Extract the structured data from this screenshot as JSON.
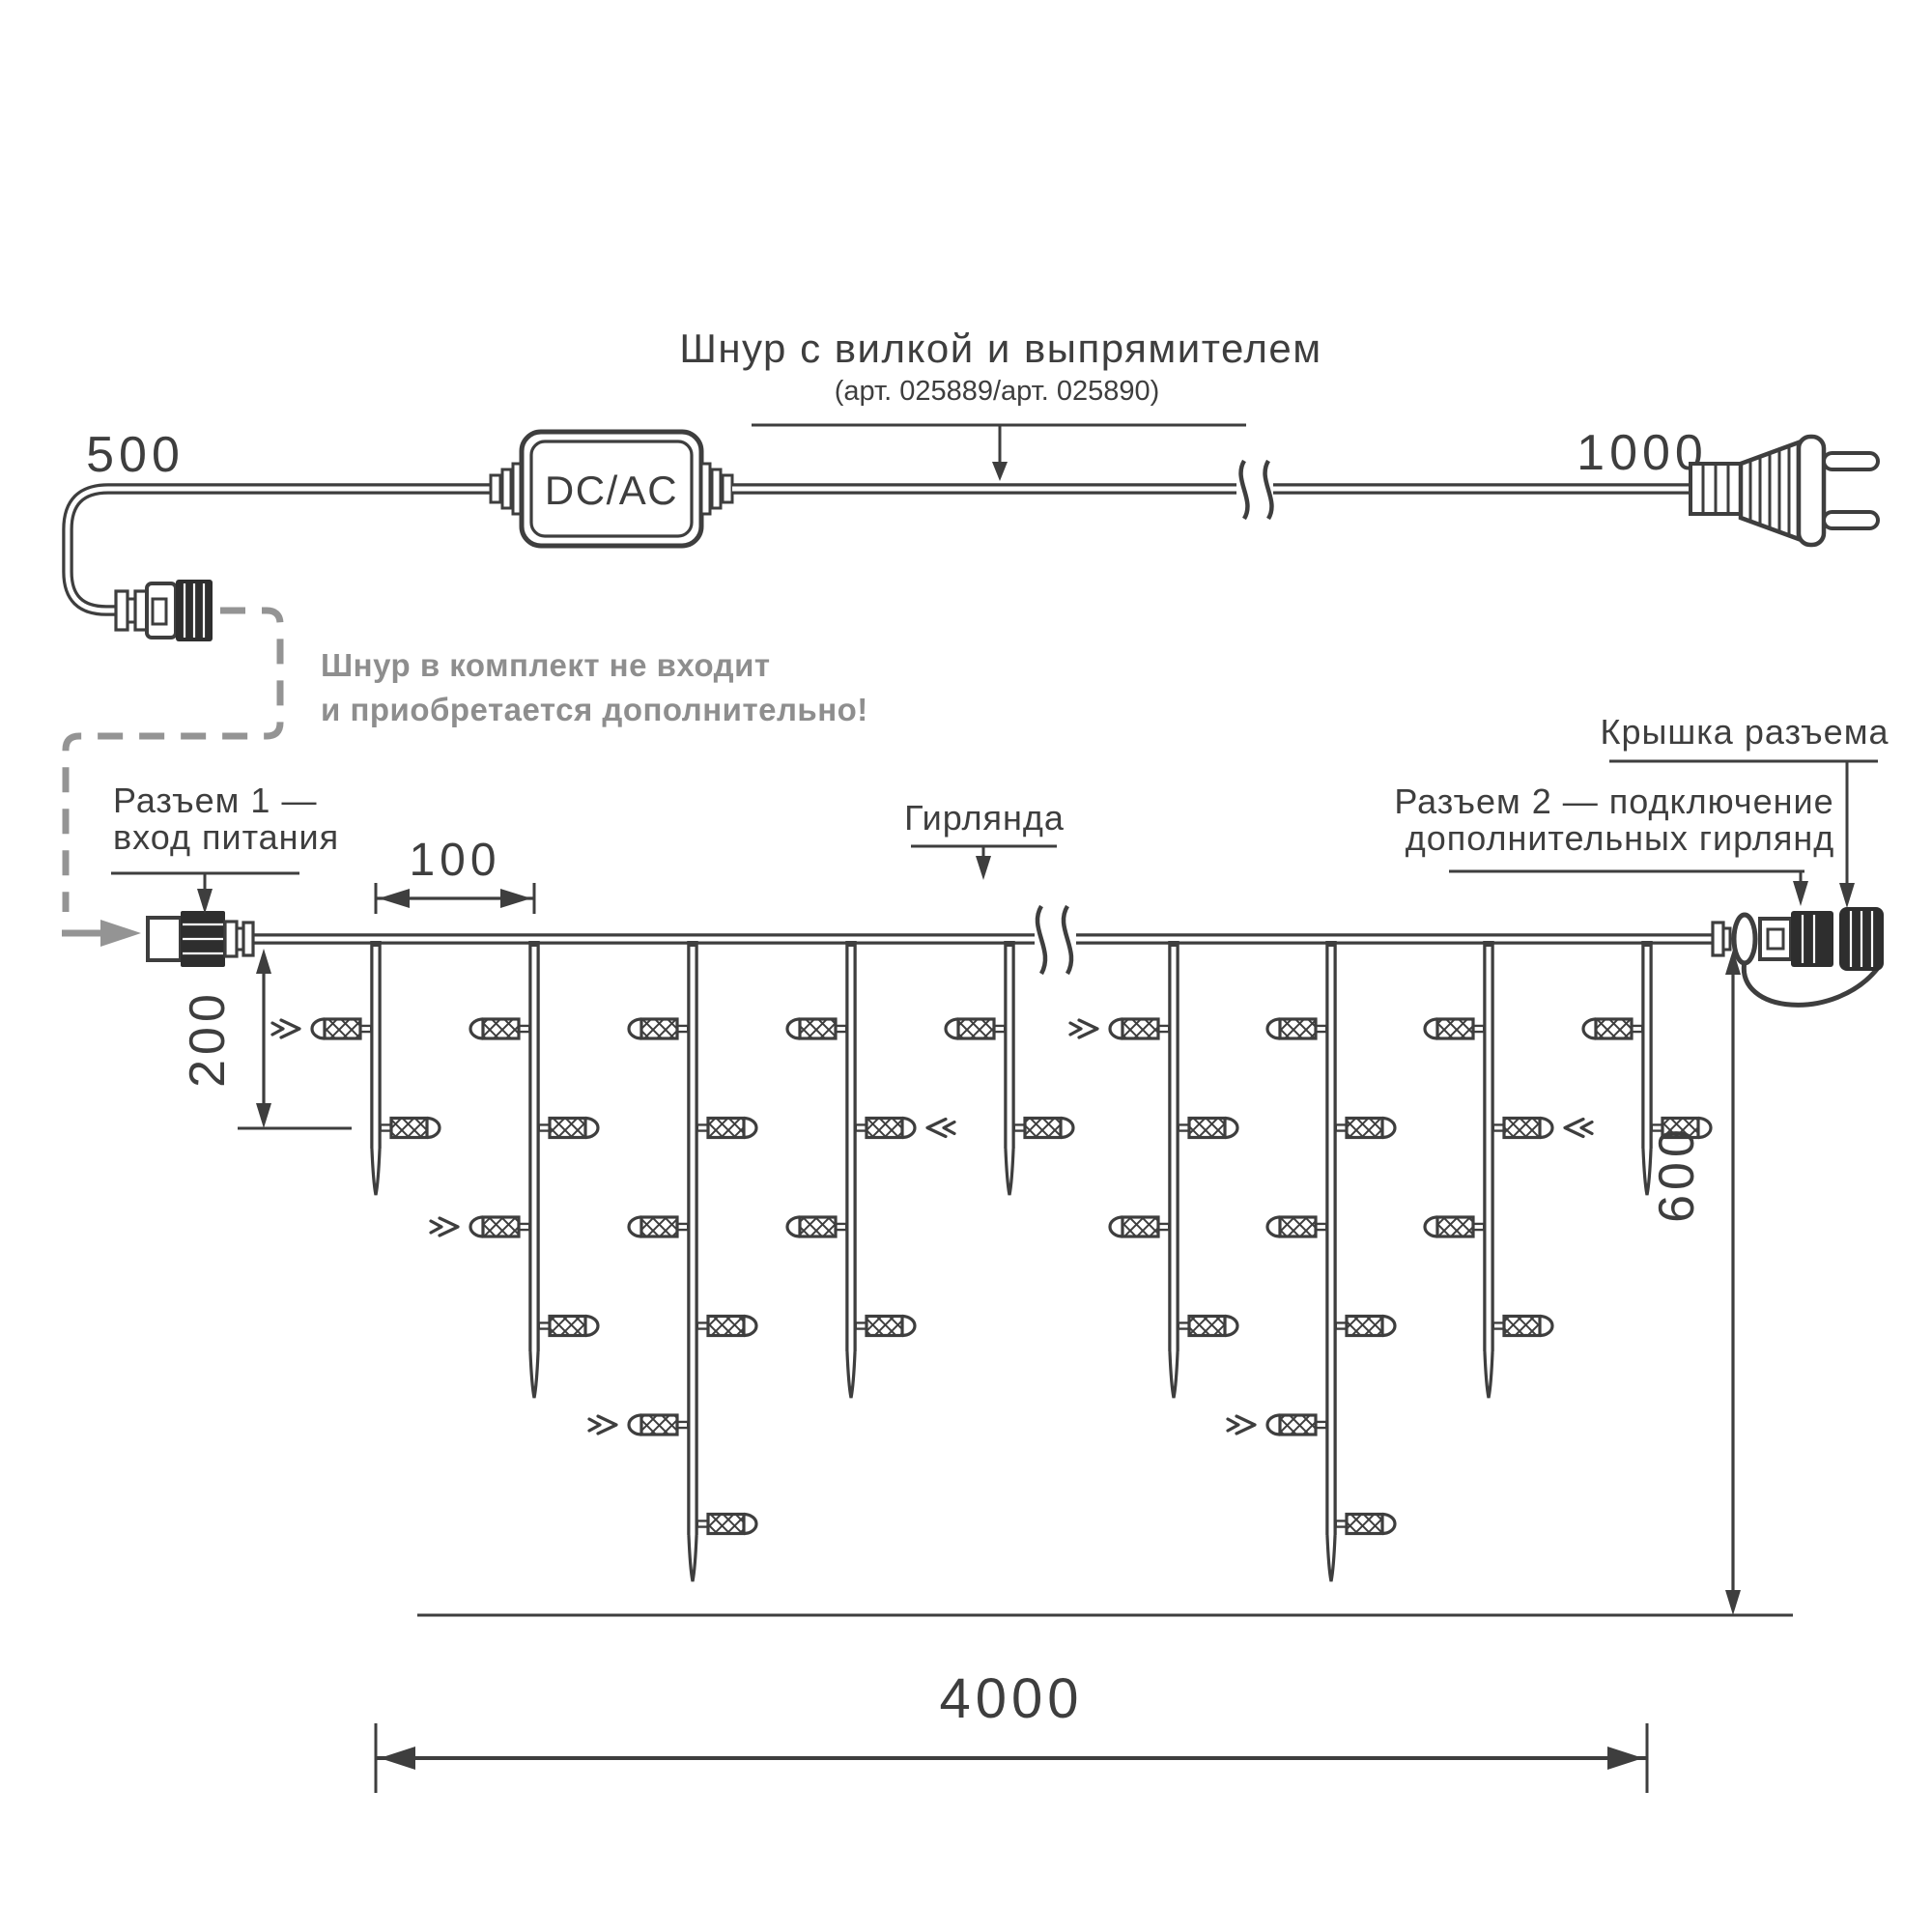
{
  "power_cord": {
    "len_left": "500",
    "len_right": "1000",
    "converter": "DC/AC",
    "label_line1": "Шнур с вилкой и выпрямителем",
    "label_line2": "(арт. 025889/арт. 025890)"
  },
  "note": {
    "line1": "Шнур в комплект не входит",
    "line2": "и приобретается дополнительно!"
  },
  "labels": {
    "connector1_line1": "Разъем 1 —",
    "connector1_line2": "вход питания",
    "garland": "Гирлянда",
    "connector2_line1": "Разъем 2 — подключение",
    "connector2_line2": "дополнительных гирлянд",
    "cap": "Крышка разъема"
  },
  "dimensions": {
    "spacing": "100",
    "depth_first": "200",
    "depth_max": "600",
    "total": "4000"
  },
  "colors": {
    "line": "#3e3e3e",
    "muted": "#949494"
  }
}
